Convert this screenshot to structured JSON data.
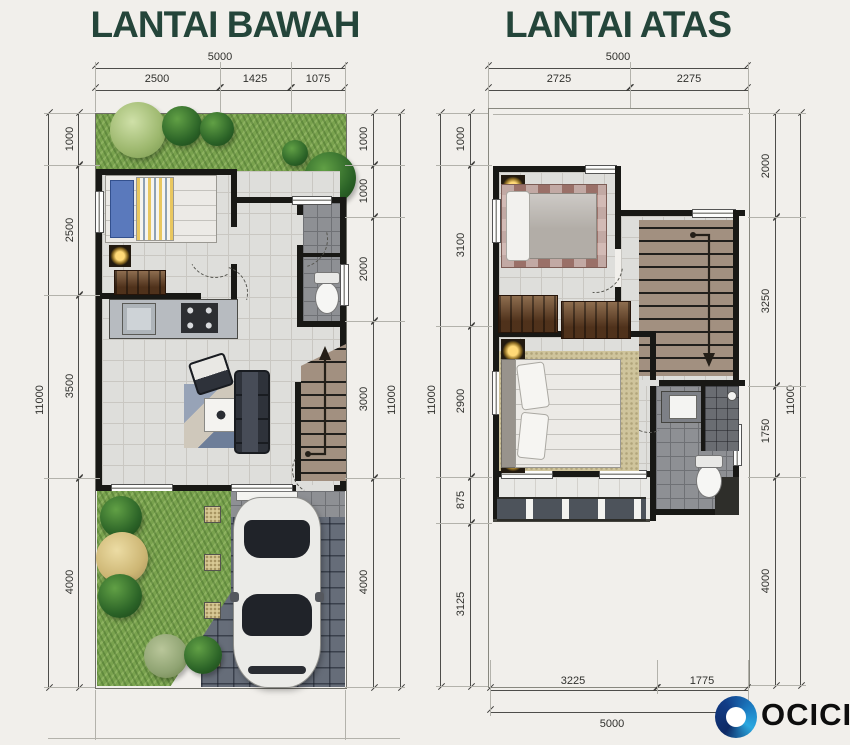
{
  "floors": [
    {
      "title": "LANTAI BAWAH",
      "dims": {
        "top": {
          "total": "5000",
          "segments": [
            "2500",
            "1425",
            "1075"
          ]
        },
        "left": {
          "total": "11000",
          "segments": [
            "1000",
            "2500",
            "3500",
            "4000"
          ]
        },
        "right": {
          "total": "11000",
          "segments": [
            "1000",
            "1000",
            "2000",
            "3000",
            "4000"
          ]
        }
      }
    },
    {
      "title": "LANTAI ATAS",
      "dims": {
        "top": {
          "total": "5000",
          "segments": [
            "2725",
            "2275"
          ]
        },
        "left": {
          "total": "11000",
          "segments": [
            "1000",
            "3100",
            "2900",
            "875",
            "3125"
          ]
        },
        "right": {
          "total": "11000",
          "segments": [
            "2000",
            "3250",
            "1750",
            "4000"
          ]
        },
        "bottom": {
          "total": "5000",
          "segments": [
            "3225",
            "1775"
          ]
        }
      }
    }
  ],
  "brand": {
    "name": "OCICIO"
  },
  "colors": {
    "title": "#24453a",
    "wall": "#181815",
    "grass": "#79a24e",
    "paving": "#666d79",
    "logo_blue_dark": "#0e2a66",
    "logo_blue_light": "#2aa8e0"
  }
}
